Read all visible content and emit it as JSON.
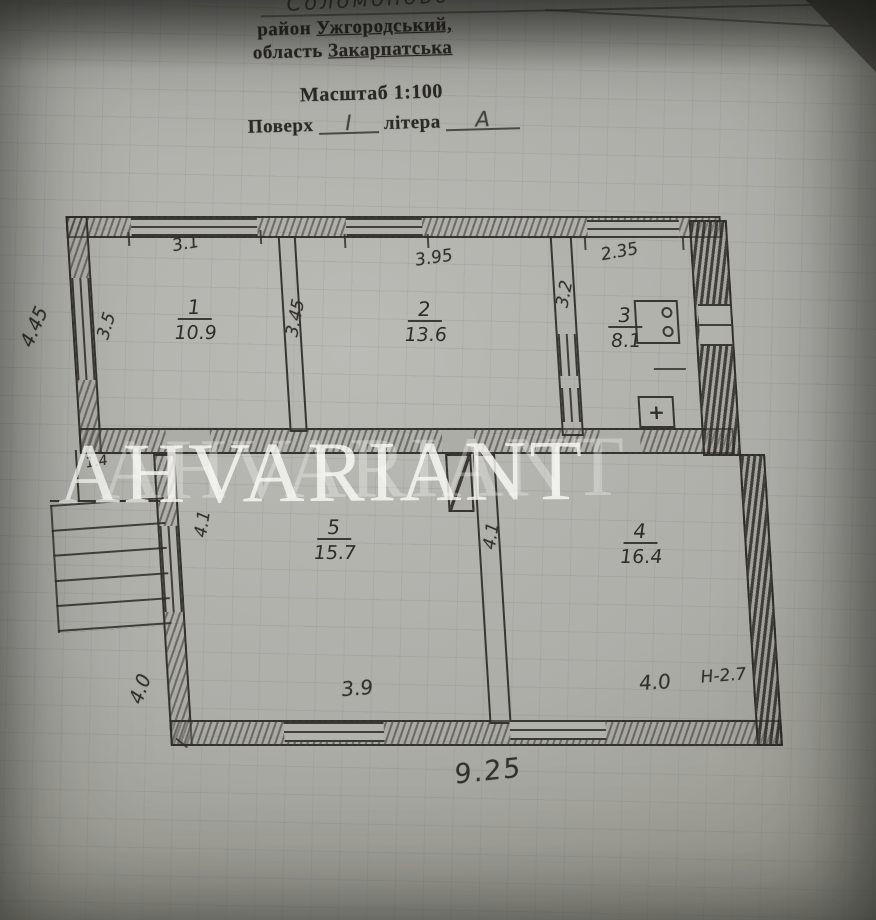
{
  "document": {
    "handwritten_settlement": "Соломоново",
    "district": {
      "label": "район",
      "value": "Ужгородський,"
    },
    "region": {
      "label": "область",
      "value": "Закарпатська"
    },
    "scale_line": "Масштаб 1:100",
    "floor": {
      "label": "Поверх",
      "value": "І"
    },
    "letter": {
      "label": "літера",
      "value": "А"
    }
  },
  "watermark": {
    "text": "AHVARIANT",
    "color": "#faf9f6"
  },
  "plan": {
    "type": "floor-plan",
    "rooms": [
      {
        "number": "1",
        "area": "10.9"
      },
      {
        "number": "2",
        "area": "13.6"
      },
      {
        "number": "3",
        "area": "8.1"
      },
      {
        "number": "5",
        "area": "15.7"
      },
      {
        "number": "4",
        "area": "16.4"
      }
    ],
    "dims": {
      "outer_left": "4.45",
      "room1_left": "3.5",
      "room1_top": "3.1",
      "wall_1_2": "3.45",
      "room2_top": "3.95",
      "wall_2_3": "3.2",
      "room3_top": "2.35",
      "porch": "1.4",
      "room5_left": "4.1",
      "wall_5_4": "4.1",
      "room5_bottom": "3.9",
      "room4_bottom": "4.0",
      "height_note": "Н-2.7",
      "outer_lower_left": "4.0",
      "total_width": "9.25"
    },
    "icons": {
      "plus": "+"
    },
    "colors": {
      "pencil": "#2e2b26",
      "paper": "#b2b2ae"
    }
  }
}
